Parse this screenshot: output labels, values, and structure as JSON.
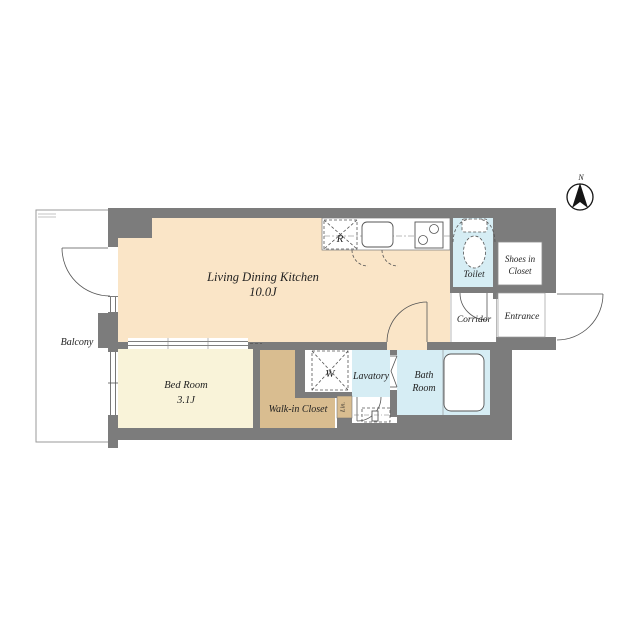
{
  "compass": {
    "north_label": "N"
  },
  "colors": {
    "wall": "#7c7c7c",
    "ldk": "#fae5c7",
    "bedroom": "#f9f3d9",
    "closet": "#d9bd90",
    "water": "#d6edf4",
    "white": "#ffffff"
  },
  "rooms": {
    "ldk": {
      "name": "Living Dining Kitchen",
      "size": "10.0J"
    },
    "bedroom": {
      "name": "Bed Room",
      "size": "3.1J"
    },
    "walk_in_closet": {
      "name": "Walk-in Closet"
    },
    "lavatory": {
      "name": "Lavatory"
    },
    "bath_room": {
      "line1": "Bath",
      "line2": "Room"
    },
    "toilet": {
      "name": "Toilet"
    },
    "corridor": {
      "name": "Corridor"
    },
    "entrance": {
      "name": "Entrance"
    },
    "shoes_in_closet": {
      "line1": "Shoes in",
      "line2": "Closet"
    },
    "balcony": {
      "name": "Balcony"
    }
  },
  "fixtures": {
    "refrigerator_label": "R",
    "washer_label": "W",
    "linen_label": "Lin."
  }
}
